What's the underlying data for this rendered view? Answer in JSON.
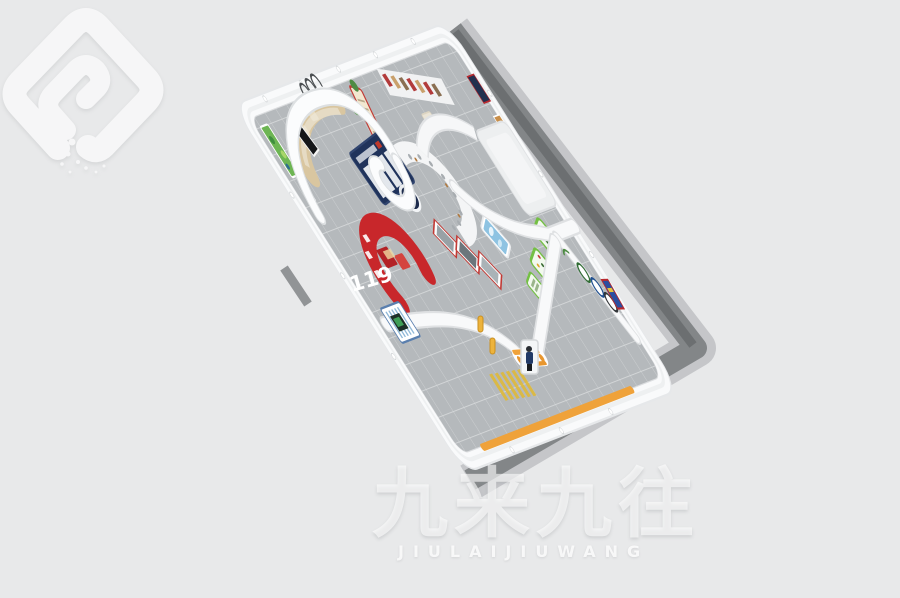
{
  "scene": {
    "type": "3d-render",
    "subject": "Bird's-eye 3D render of a fire-safety themed exhibition hall interior with curved white partition walls",
    "background_color": "#e8e9ea",
    "shadow_color": "#7b7e81",
    "shell_color": "#f9fafb",
    "floor_tile_color": "#b5b9bc",
    "palette": {
      "fire_red": "#c8272b",
      "navy_display": "#20335b",
      "display_green": "#74c044",
      "signal_orange": "#f0a23a",
      "sky_blue": "#8ec3e2",
      "wood_tan": "#d9c6a0",
      "crosswalk_yellow": "#dfb93a"
    },
    "labels": {
      "fire_hotline": "119"
    }
  },
  "watermark": {
    "text": "九来九往",
    "subtext": "JIULAIJIUWANG"
  }
}
